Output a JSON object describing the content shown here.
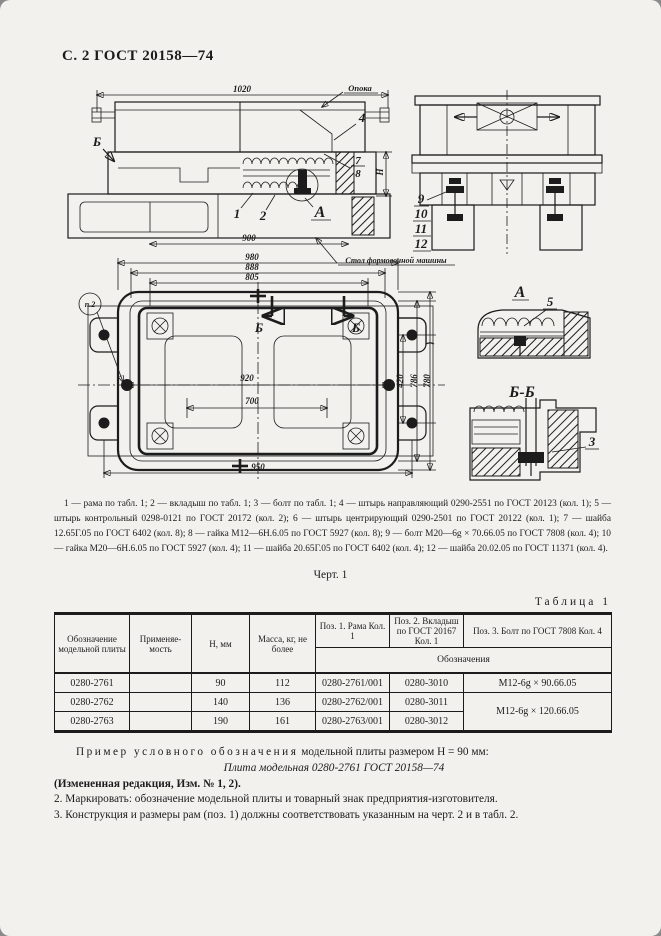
{
  "page": {
    "header": "С. 2 ГОСТ 20158—74",
    "figure_caption": "Черт. 1"
  },
  "drawing": {
    "side_view": {
      "dim_width": "1020",
      "dim_bottom": "900",
      "view_label": "Б",
      "flask_label": "Опока",
      "part_4": "4",
      "part_7": "7",
      "part_8": "8",
      "height_label": "Н",
      "part_1": "1",
      "part_2": "2",
      "detail_label": "А"
    },
    "end_view": {
      "part_9": "9",
      "part_10": "10",
      "part_11": "11",
      "part_12": "12"
    },
    "plan_view": {
      "dim_980": "980",
      "dim_888": "888",
      "dim_805": "805",
      "dim_920": "920",
      "dim_700": "700",
      "dim_950": "950",
      "dim_420": "420",
      "dim_786": "786",
      "dim_780": "780",
      "item_label": "п.2",
      "section_label_left": "Б",
      "section_label_right": "Б",
      "machine_table_note": "Стол формовочной машины"
    },
    "detail_a": {
      "title": "А",
      "part_5": "5"
    },
    "detail_bb": {
      "title": "Б-Б",
      "part_3": "3"
    },
    "parts_list": "1 — рама по табл. 1; 2 — вкладыш по табл. 1; 3 — болт по табл. 1; 4 — штырь направляющий 0290-2551 по ГОСТ 20123 (кол. 1); 5 — штырь контрольный 0298-0121 по ГОСТ 20172 (кол. 2); 6 — штырь центрирующий 0290-2501 по ГОСТ 20122 (кол. 1); 7 — шайба 12.65Г.05 по ГОСТ 6402 (кол. 8); 8 — гайка М12—6Н.6.05 по ГОСТ 5927 (кол. 8); 9 — болт М20—6g × 70.66.05 по ГОСТ 7808 (кол. 4); 10 — гайка М20—6Н.6.05 по ГОСТ 5927 (кол. 4); 11 — шайба 20.65Г.05 по ГОСТ 6402 (кол. 4); 12 — шайба 20.02.05 по ГОСТ 11371 (кол. 4)."
  },
  "table": {
    "title": "Таблица 1",
    "col_designation": "Обозначение модельной плиты",
    "col_applicability": "Применяе­мость",
    "col_h": "Н, мм",
    "col_mass": "Масса, кг, не более",
    "col_pos1": "Поз. 1. Рама Кол. 1",
    "col_pos2": "Поз. 2. Вкладыш по ГОСТ 20167 Кол. 1",
    "col_pos3": "Поз. 3. Болт по ГОСТ 7808 Кол. 4",
    "subheader": "Обозначения",
    "rows": [
      [
        "0280-2761",
        "",
        "90",
        "112",
        "0280-2761/001",
        "0280-3010",
        "М12-6g × 90.66.05"
      ],
      [
        "0280-2762",
        "",
        "140",
        "136",
        "0280-2762/001",
        "0280-3011",
        "М12-6g × 120.66.05"
      ],
      [
        "0280-2763",
        "",
        "190",
        "161",
        "0280-2763/001",
        "0280-3012"
      ]
    ]
  },
  "notes": {
    "example_spaced": "Пример условного обозначения",
    "example_rest": "модельной плиты размером Н = 90 мм:",
    "example_designation": "Плита модельная 0280-2761 ГОСТ 20158—74",
    "revision": "(Измененная редакция, Изм. № 1, 2).",
    "note2": "2. Маркировать: обозначение модельной плиты и товарный знак предприятия-изготовителя.",
    "note3": "3. Конструкция и размеры рам (поз. 1) должны соответствовать указанным на черт. 2 и в табл. 2."
  }
}
